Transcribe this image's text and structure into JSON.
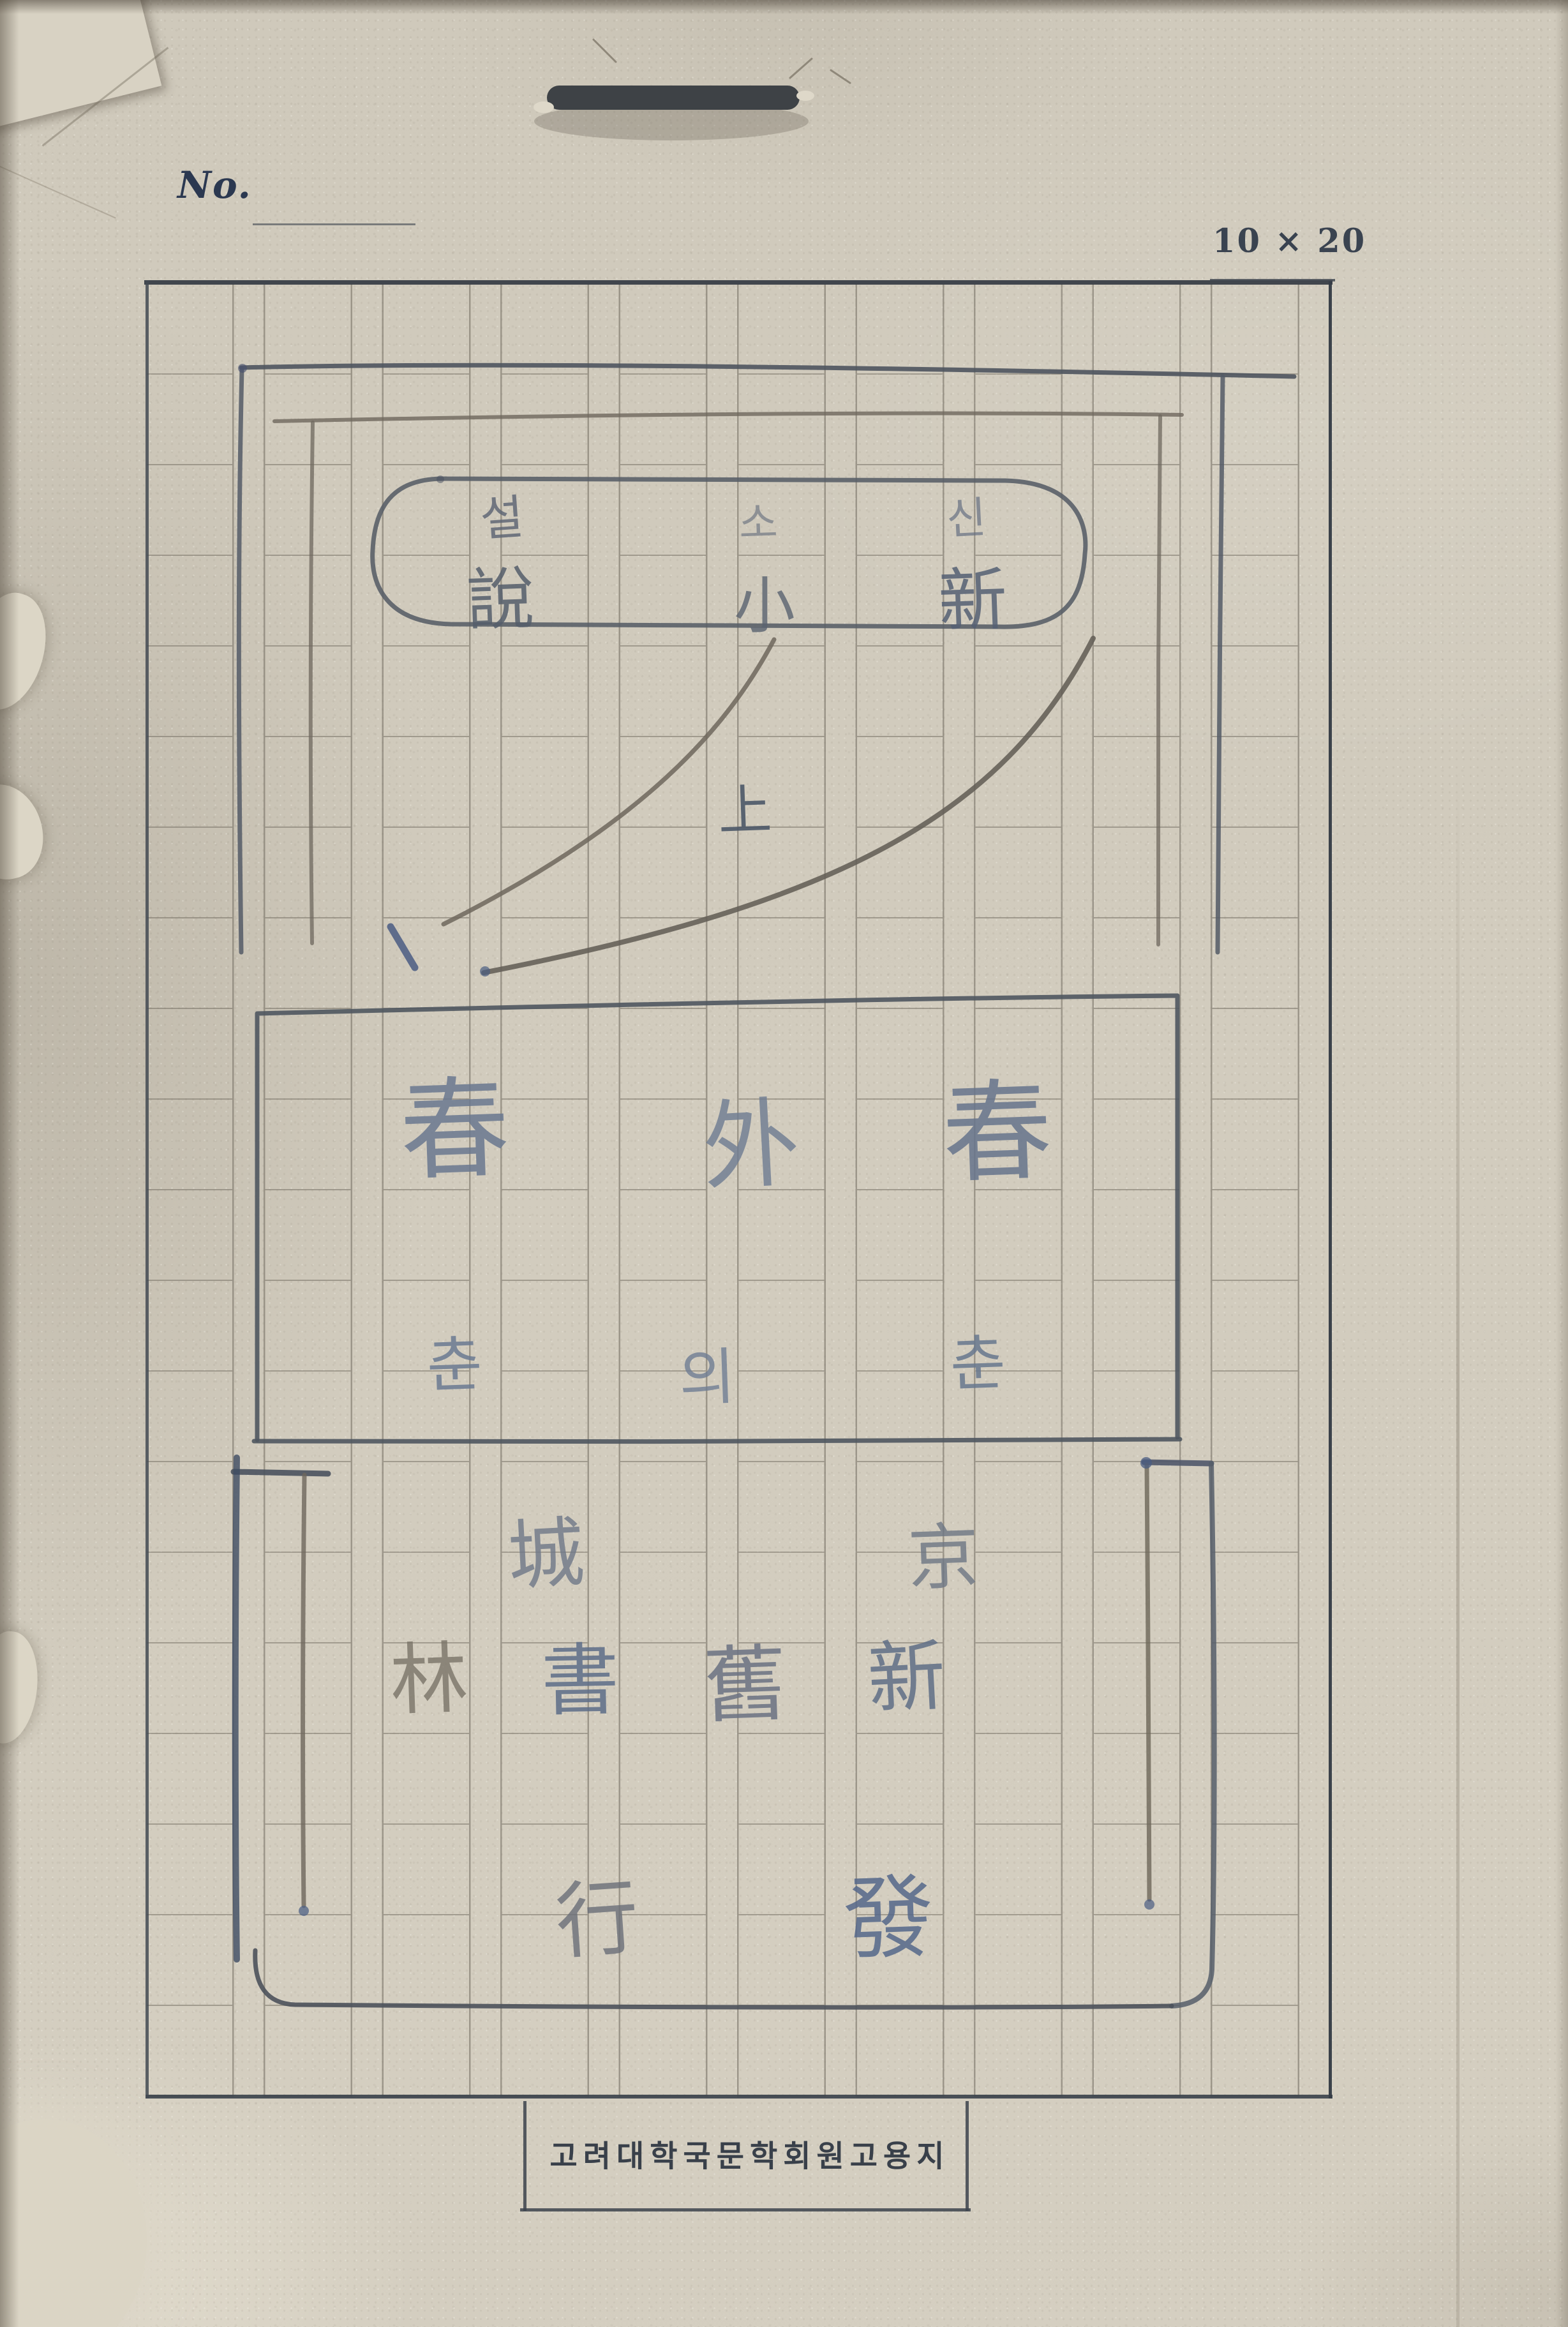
{
  "header": {
    "no_label": "No.",
    "size_label": "10 × 20"
  },
  "ink": {
    "seal_hangul": [
      "설",
      "소",
      "신"
    ],
    "seal_hanja": [
      "說",
      "小",
      "新"
    ],
    "volume_marker": "上",
    "title_hanja": [
      "春",
      "外",
      "春"
    ],
    "title_hangul": [
      "춘",
      "의",
      "춘"
    ],
    "publisher_row1": [
      "城",
      "京"
    ],
    "publisher_row2": [
      "林",
      "書",
      "舊",
      "新"
    ],
    "publisher_row3": [
      "行",
      "發"
    ]
  },
  "footer": {
    "label": "고려대학국문학회원고용지"
  },
  "colors": {
    "paper": "#d0cabc",
    "grid_line": "#6f695e",
    "border": "#343b43",
    "ink_gray": "#565f6b",
    "ink_brown": "#7b7366",
    "ink_blue": "#53648a",
    "title_ink": "#6a7890"
  }
}
